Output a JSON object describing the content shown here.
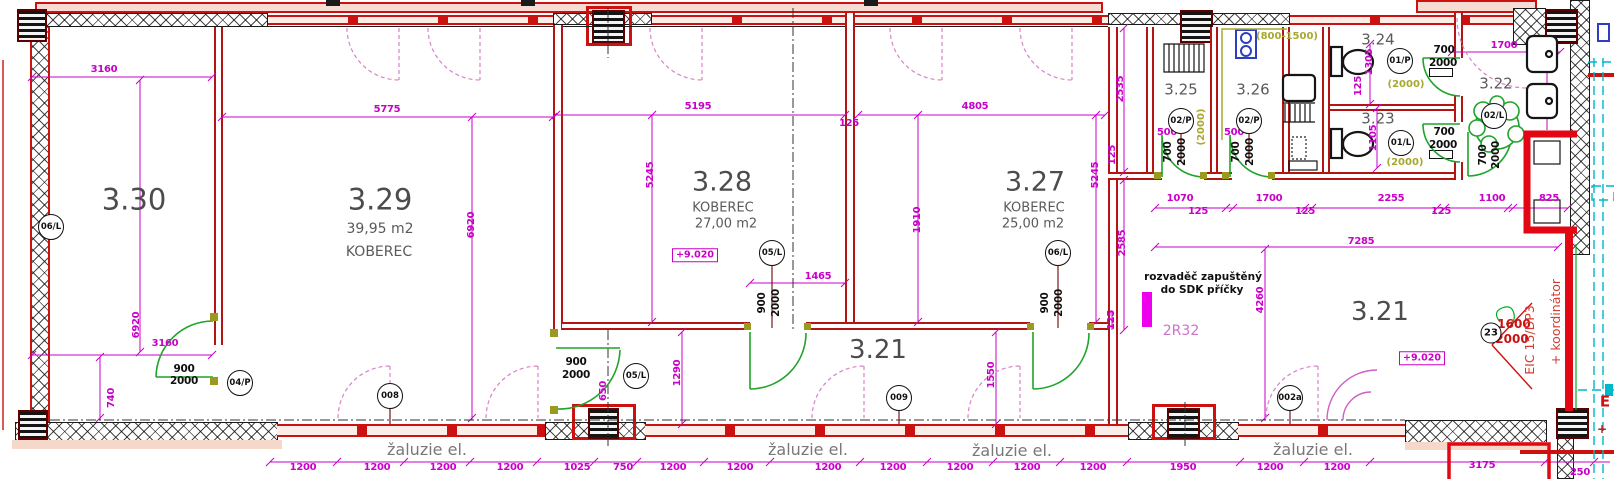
{
  "plan": {
    "rooms": [
      {
        "number": "3.30"
      },
      {
        "number": "3.29",
        "area": "39,95 m2",
        "finish": "KOBEREC"
      },
      {
        "number": "3.28",
        "area": "27,00 m2",
        "finish": "KOBEREC"
      },
      {
        "number": "3.27",
        "area": "25,00 m2",
        "finish": "KOBEREC"
      },
      {
        "number": "3.21"
      },
      {
        "number": "3.22"
      },
      {
        "number": "3.23"
      },
      {
        "number": "3.24"
      },
      {
        "number": "3.25"
      },
      {
        "number": "3.26"
      }
    ],
    "colors": {
      "wall_red": "#cc1111",
      "dimension_magenta": "#c800c8",
      "door_green": "#1fa32a",
      "adjacent_cyan": "#00b7c9",
      "furniture_olive": "#a8a830"
    },
    "level_marks": [
      "+9.020",
      "+9.020"
    ],
    "notes": {
      "electrical_line1": "rozvaděč zapuštěný",
      "electrical_line2": "do SDK příčky",
      "circuit": "2R32",
      "blinds": "žaluzie el.",
      "coordinator_line1": "EIC 15/DP3",
      "coordinator_line2": "+ koordinátor"
    },
    "tags": [
      {
        "t": "06/L",
        "x": 51,
        "y": 227
      },
      {
        "t": "04/P",
        "x": 240,
        "y": 383
      },
      {
        "t": "008",
        "x": 390,
        "y": 396
      },
      {
        "t": "05/L",
        "x": 636,
        "y": 376
      },
      {
        "t": "05/L",
        "x": 772,
        "y": 253
      },
      {
        "t": "06/L",
        "x": 1058,
        "y": 253
      },
      {
        "t": "009",
        "x": 899,
        "y": 398
      },
      {
        "t": "002a",
        "x": 1290,
        "y": 398
      },
      {
        "t": "02/P",
        "x": 1181,
        "y": 121
      },
      {
        "t": "02/P",
        "x": 1249,
        "y": 121
      },
      {
        "t": "01/P",
        "x": 1400,
        "y": 61
      },
      {
        "t": "01/L",
        "x": 1401,
        "y": 143
      },
      {
        "t": "02/L",
        "x": 1494,
        "y": 116
      },
      {
        "t": "23",
        "x": 1491,
        "y": 333,
        "sm": true
      }
    ],
    "labels": [
      {
        "t": "3.30",
        "x": 134,
        "y": 200,
        "k": "r30"
      },
      {
        "t": "3.29",
        "x": 380,
        "y": 200,
        "k": "r30"
      },
      {
        "t": "39,95 m2",
        "x": 380,
        "y": 229,
        "k": "sub"
      },
      {
        "t": "KOBEREC",
        "x": 379,
        "y": 252,
        "k": "sub"
      },
      {
        "t": "3.28",
        "x": 722,
        "y": 182,
        "k": "r28"
      },
      {
        "t": "KOBEREC",
        "x": 723,
        "y": 208,
        "k": "sub2"
      },
      {
        "t": "27,00 m2",
        "x": 726,
        "y": 224,
        "k": "sub2"
      },
      {
        "t": "3.27",
        "x": 1035,
        "y": 182,
        "k": "r28"
      },
      {
        "t": "KOBEREC",
        "x": 1034,
        "y": 208,
        "k": "sub2"
      },
      {
        "t": "25,00 m2",
        "x": 1033,
        "y": 224,
        "k": "sub2"
      },
      {
        "t": "3.21",
        "x": 878,
        "y": 350,
        "k": "r26"
      },
      {
        "t": "3.21",
        "x": 1380,
        "y": 312,
        "k": "r26"
      },
      {
        "t": "3.22",
        "x": 1496,
        "y": 84,
        "k": "r15"
      },
      {
        "t": "3.24",
        "x": 1378,
        "y": 40,
        "k": "r15"
      },
      {
        "t": "3.23",
        "x": 1378,
        "y": 119,
        "k": "r15"
      },
      {
        "t": "3.25",
        "x": 1181,
        "y": 90,
        "k": "r15"
      },
      {
        "t": "3.26",
        "x": 1253,
        "y": 90,
        "k": "r15"
      },
      {
        "t": "3160",
        "x": 104,
        "y": 70,
        "k": "dim"
      },
      {
        "t": "5775",
        "x": 387,
        "y": 110,
        "k": "dim"
      },
      {
        "t": "5195",
        "x": 698,
        "y": 107,
        "k": "dim"
      },
      {
        "t": "125",
        "x": 849,
        "y": 124,
        "k": "dim"
      },
      {
        "t": "4805",
        "x": 975,
        "y": 107,
        "k": "dim"
      },
      {
        "t": "1465",
        "x": 818,
        "y": 277,
        "k": "dim"
      },
      {
        "t": "1070",
        "x": 1180,
        "y": 199,
        "k": "dim"
      },
      {
        "t": "125",
        "x": 1198,
        "y": 212,
        "k": "dim"
      },
      {
        "t": "1700",
        "x": 1269,
        "y": 199,
        "k": "dim"
      },
      {
        "t": "125",
        "x": 1305,
        "y": 212,
        "k": "dim"
      },
      {
        "t": "2255",
        "x": 1391,
        "y": 199,
        "k": "dim"
      },
      {
        "t": "125",
        "x": 1441,
        "y": 212,
        "k": "dim"
      },
      {
        "t": "1100",
        "x": 1492,
        "y": 199,
        "k": "dim"
      },
      {
        "t": "825",
        "x": 1549,
        "y": 199,
        "k": "dim"
      },
      {
        "t": "7285",
        "x": 1361,
        "y": 242,
        "k": "dim"
      },
      {
        "t": "1700",
        "x": 1504,
        "y": 46,
        "k": "dim"
      },
      {
        "t": "3160",
        "x": 165,
        "y": 344,
        "k": "dim"
      },
      {
        "t": "500",
        "x": 1167,
        "y": 133,
        "k": "dim"
      },
      {
        "t": "500",
        "x": 1234,
        "y": 133,
        "k": "dim"
      },
      {
        "t": "1200",
        "x": 303,
        "y": 468,
        "k": "dim"
      },
      {
        "t": "1200",
        "x": 377,
        "y": 468,
        "k": "dim"
      },
      {
        "t": "1200",
        "x": 443,
        "y": 468,
        "k": "dim"
      },
      {
        "t": "1200",
        "x": 510,
        "y": 468,
        "k": "dim"
      },
      {
        "t": "1025",
        "x": 577,
        "y": 468,
        "k": "dim"
      },
      {
        "t": "750",
        "x": 623,
        "y": 468,
        "k": "dim"
      },
      {
        "t": "1200",
        "x": 673,
        "y": 468,
        "k": "dim"
      },
      {
        "t": "1200",
        "x": 740,
        "y": 468,
        "k": "dim"
      },
      {
        "t": "1200",
        "x": 828,
        "y": 468,
        "k": "dim"
      },
      {
        "t": "1200",
        "x": 893,
        "y": 468,
        "k": "dim"
      },
      {
        "t": "1200",
        "x": 960,
        "y": 468,
        "k": "dim"
      },
      {
        "t": "1200",
        "x": 1027,
        "y": 468,
        "k": "dim"
      },
      {
        "t": "1200",
        "x": 1093,
        "y": 468,
        "k": "dim"
      },
      {
        "t": "1950",
        "x": 1183,
        "y": 468,
        "k": "dim"
      },
      {
        "t": "1200",
        "x": 1270,
        "y": 468,
        "k": "dim"
      },
      {
        "t": "1200",
        "x": 1337,
        "y": 468,
        "k": "dim"
      },
      {
        "t": "3175",
        "x": 1482,
        "y": 466,
        "k": "dim"
      },
      {
        "t": "250",
        "x": 1580,
        "y": 473,
        "k": "dim"
      },
      {
        "t": "6920",
        "x": 472,
        "y": 225,
        "k": "dimv"
      },
      {
        "t": "6920",
        "x": 137,
        "y": 325,
        "k": "dimv"
      },
      {
        "t": "5245",
        "x": 651,
        "y": 175,
        "k": "dimv"
      },
      {
        "t": "5245",
        "x": 1096,
        "y": 175,
        "k": "dimv"
      },
      {
        "t": "1910",
        "x": 918,
        "y": 220,
        "k": "dimv"
      },
      {
        "t": "2535",
        "x": 1121,
        "y": 89,
        "k": "dimv"
      },
      {
        "t": "125",
        "x": 1113,
        "y": 155,
        "k": "dimv"
      },
      {
        "t": "740",
        "x": 112,
        "y": 398,
        "k": "dimv"
      },
      {
        "t": "1290",
        "x": 678,
        "y": 373,
        "k": "dimv"
      },
      {
        "t": "650",
        "x": 604,
        "y": 391,
        "k": "dimv"
      },
      {
        "t": "1550",
        "x": 992,
        "y": 375,
        "k": "dimv"
      },
      {
        "t": "2585",
        "x": 1123,
        "y": 243,
        "k": "dimv"
      },
      {
        "t": "125",
        "x": 1112,
        "y": 320,
        "k": "dimv"
      },
      {
        "t": "4260",
        "x": 1261,
        "y": 300,
        "k": "dimv"
      },
      {
        "t": "1305",
        "x": 1370,
        "y": 62,
        "k": "dimv"
      },
      {
        "t": "125",
        "x": 1359,
        "y": 86,
        "k": "dimv"
      },
      {
        "t": "1105",
        "x": 1374,
        "y": 138,
        "k": "dimv"
      },
      {
        "t": "900",
        "x": 184,
        "y": 369,
        "k": "blk"
      },
      {
        "t": "2000",
        "x": 184,
        "y": 381,
        "k": "blk"
      },
      {
        "t": "900",
        "x": 576,
        "y": 362,
        "k": "blk"
      },
      {
        "t": "2000",
        "x": 576,
        "y": 375,
        "k": "blk"
      },
      {
        "t": "900",
        "x": 762,
        "y": 303,
        "k": "blkv"
      },
      {
        "t": "2000",
        "x": 776,
        "y": 303,
        "k": "blkv"
      },
      {
        "t": "900",
        "x": 1045,
        "y": 303,
        "k": "blkv"
      },
      {
        "t": "2000",
        "x": 1059,
        "y": 303,
        "k": "blkv"
      },
      {
        "t": "700",
        "x": 1168,
        "y": 152,
        "k": "blkv"
      },
      {
        "t": "2000",
        "x": 1182,
        "y": 152,
        "k": "blkv"
      },
      {
        "t": "700",
        "x": 1236,
        "y": 152,
        "k": "blkv"
      },
      {
        "t": "2000",
        "x": 1250,
        "y": 152,
        "k": "blkv"
      },
      {
        "t": "700",
        "x": 1444,
        "y": 50,
        "k": "blk"
      },
      {
        "t": "2000",
        "x": 1443,
        "y": 63,
        "k": "blk"
      },
      {
        "t": "700",
        "x": 1444,
        "y": 132,
        "k": "blk"
      },
      {
        "t": "2000",
        "x": 1443,
        "y": 145,
        "k": "blk"
      },
      {
        "t": "700",
        "x": 1483,
        "y": 155,
        "k": "blkv"
      },
      {
        "t": "2000",
        "x": 1496,
        "y": 155,
        "k": "blkv"
      },
      {
        "t": "(800-1500)",
        "x": 1287,
        "y": 37,
        "k": "olive"
      },
      {
        "t": "(2000)",
        "x": 1406,
        "y": 85,
        "k": "olive"
      },
      {
        "t": "(2000)",
        "x": 1405,
        "y": 163,
        "k": "olive"
      },
      {
        "t": "(2000)",
        "x": 1202,
        "y": 127,
        "k": "olivev"
      },
      {
        "t": "1600",
        "x": 1514,
        "y": 324,
        "k": "red"
      },
      {
        "t": "2000",
        "x": 1512,
        "y": 339,
        "k": "red"
      },
      {
        "t": "E",
        "x": 1605,
        "y": 402,
        "k": "red15"
      },
      {
        "t": "+",
        "x": 1602,
        "y": 429,
        "k": "red"
      },
      {
        "t": "EIC 15/DP3",
        "x": 1530,
        "y": 340,
        "k": "redv"
      },
      {
        "t": "+ koordinátor",
        "x": 1556,
        "y": 322,
        "k": "redv"
      },
      {
        "t": "žaluzie el.",
        "x": 427,
        "y": 450,
        "k": "grey"
      },
      {
        "t": "žaluzie el.",
        "x": 808,
        "y": 450,
        "k": "grey"
      },
      {
        "t": "žaluzie el.",
        "x": 1012,
        "y": 451,
        "k": "grey"
      },
      {
        "t": "žaluzie el.",
        "x": 1313,
        "y": 450,
        "k": "grey"
      },
      {
        "t": "rozvaděč zapuštěný",
        "x": 1203,
        "y": 277,
        "k": "note"
      },
      {
        "t": "do SDK příčky",
        "x": 1202,
        "y": 290,
        "k": "note"
      },
      {
        "t": "2R32",
        "x": 1181,
        "y": 331,
        "k": "mag"
      },
      {
        "t": "+9.020",
        "x": 695,
        "y": 255,
        "k": "pbox"
      },
      {
        "t": "+9.020",
        "x": 1422,
        "y": 358,
        "k": "pbox"
      }
    ]
  }
}
